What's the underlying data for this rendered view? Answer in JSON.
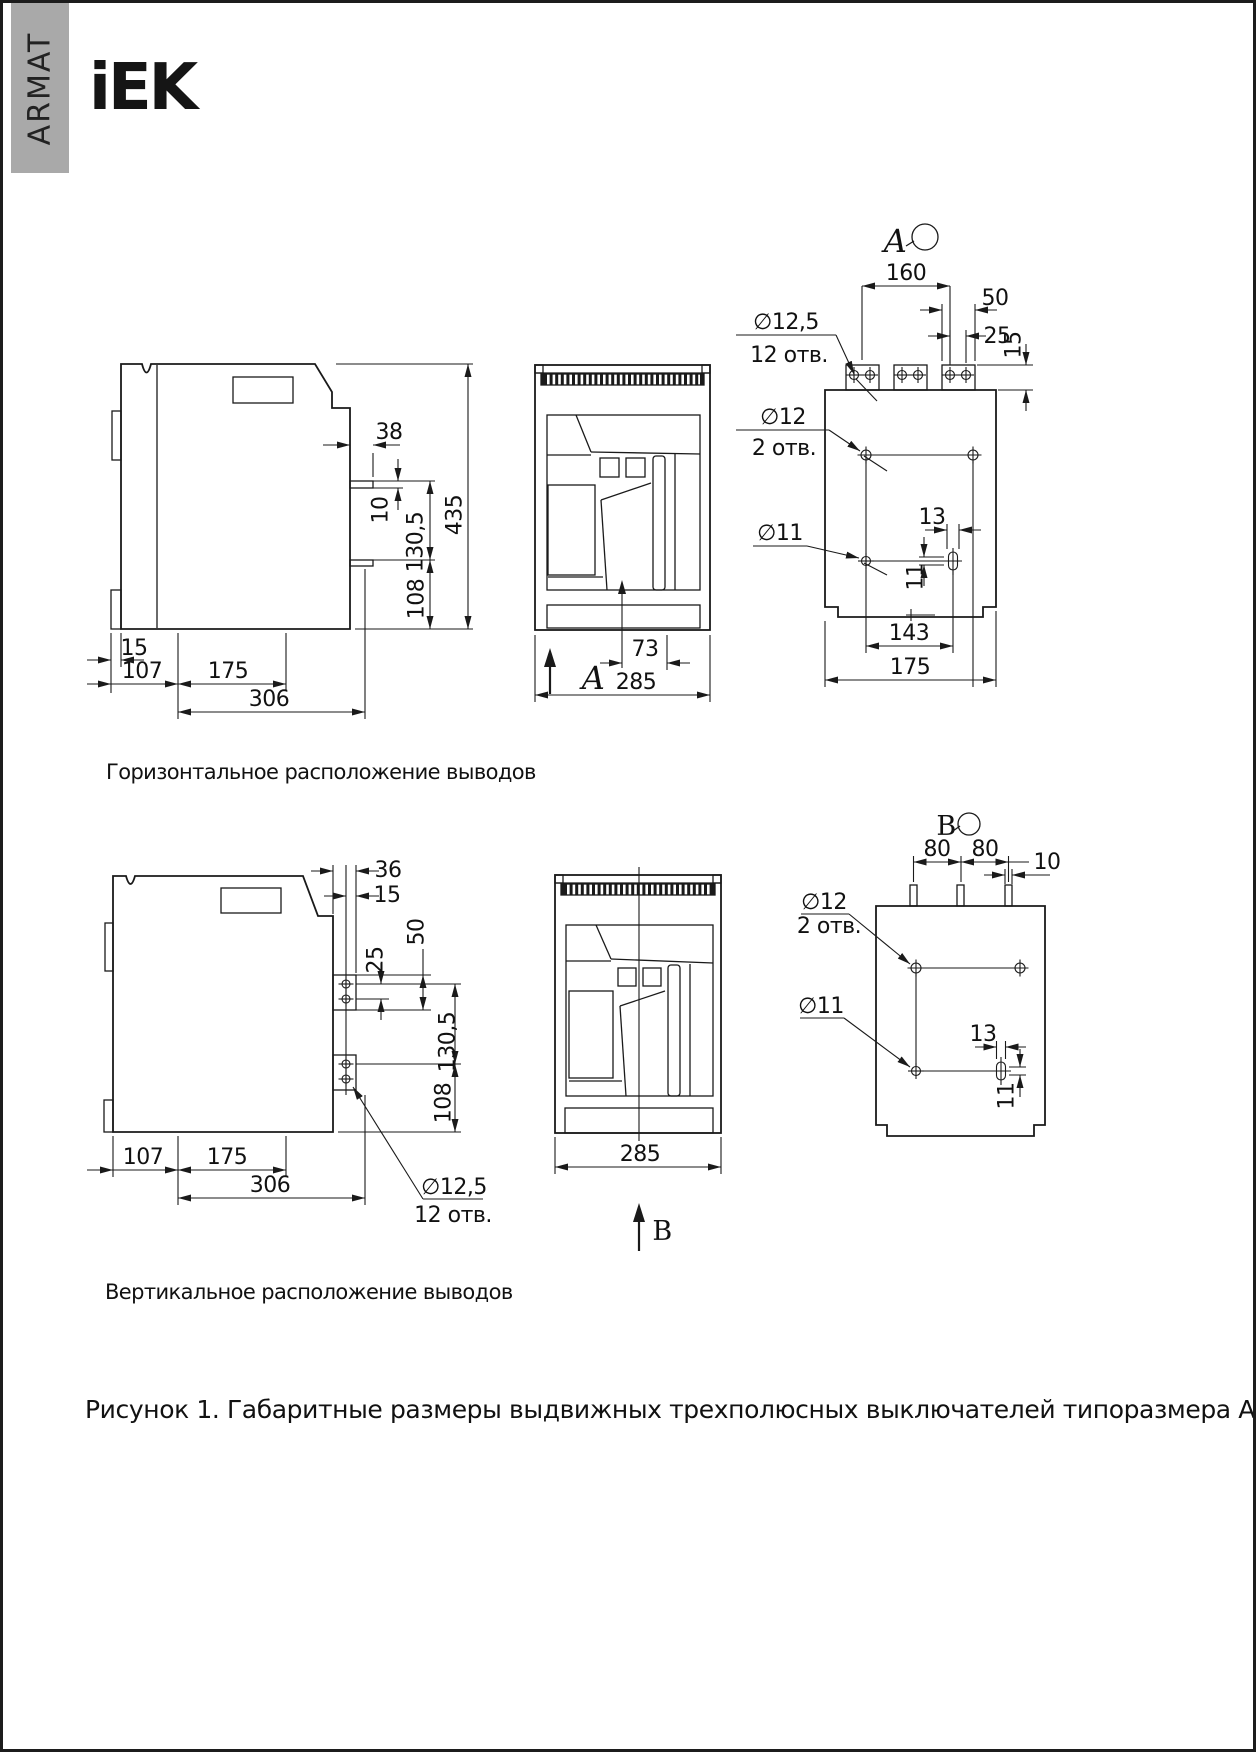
{
  "page": {
    "sidebar_vertical_label": "ARMAT",
    "logo": "iEK",
    "caption": "Рисунок 1. Габаритные размеры выдвижных трехполюсных выключателей типоразмера А"
  },
  "sections": {
    "horizontal": {
      "title": "Горизонтальное расположение выводов"
    },
    "vertical": {
      "title": "Вертикальное расположение выводов"
    }
  },
  "side_h": {
    "d38": "38",
    "d10": "10",
    "d130_5": "130,5",
    "d435": "435",
    "d108": "108",
    "d15": "15",
    "d107": "107",
    "d175": "175",
    "d306": "306"
  },
  "front_h": {
    "d73": "73",
    "d285": "285",
    "view_label": "A"
  },
  "view_a": {
    "label": "A",
    "d160": "160",
    "d50": "50",
    "d25": "25",
    "d15": "15",
    "d143": "143",
    "d175": "175",
    "d13": "13",
    "d11": "11",
    "hole_12_5": "∅12,5",
    "hole_12_5_count": "12 отв.",
    "hole_12": "∅12",
    "hole_12_count": "2 отв.",
    "hole_11": "∅11"
  },
  "side_v": {
    "d36": "36",
    "d15": "15",
    "d50": "50",
    "d25": "25",
    "d130_5": "130,5",
    "d108": "108",
    "d107": "107",
    "d175": "175",
    "d306": "306",
    "hole_12_5": "∅12,5",
    "hole_12_5_count": "12 отв."
  },
  "front_v": {
    "d285": "285",
    "view_label": "B"
  },
  "view_b": {
    "label": "B",
    "d80_left": "80",
    "d80_right": "80",
    "d10": "10",
    "d13": "13",
    "d11": "11",
    "hole_12": "∅12",
    "hole_12_count": "2 отв.",
    "hole_11": "∅11"
  }
}
